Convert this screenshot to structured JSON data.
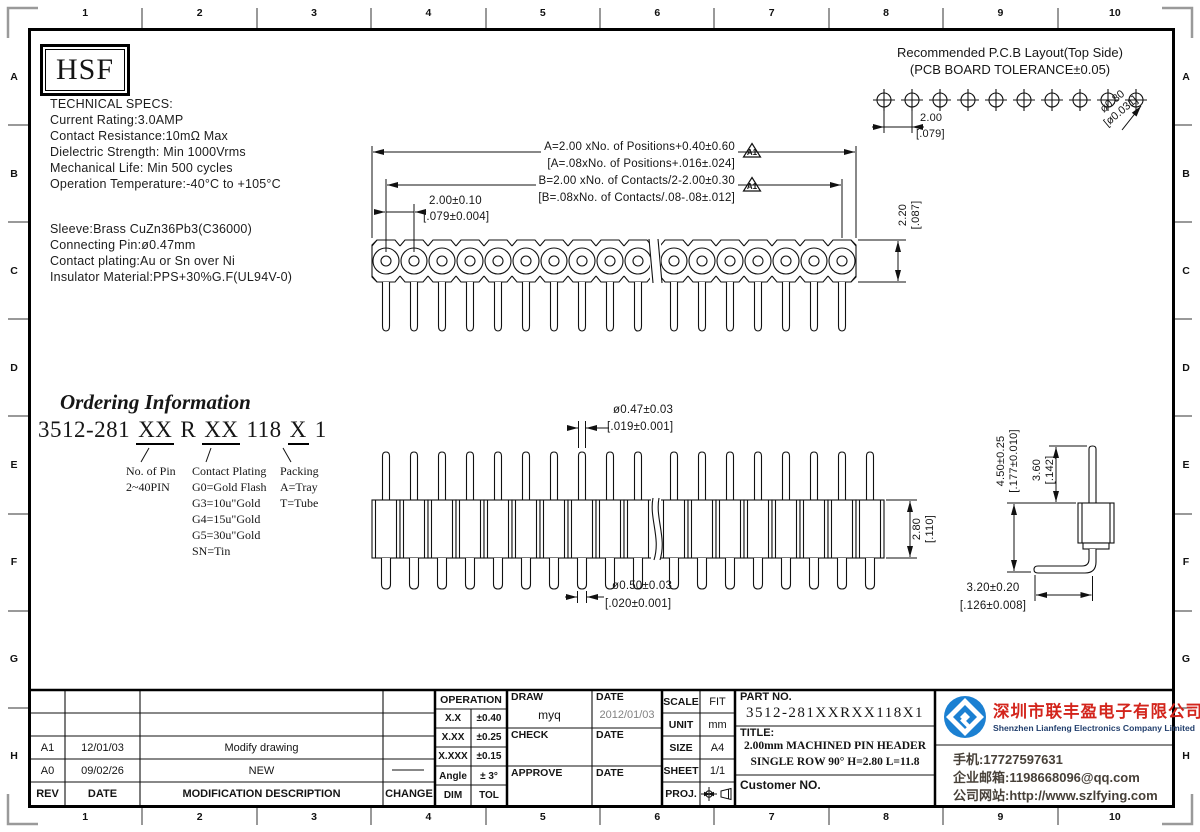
{
  "border": {
    "cols": [
      "1",
      "2",
      "3",
      "4",
      "5",
      "6",
      "7",
      "8",
      "9",
      "10"
    ],
    "rows": [
      "A",
      "B",
      "C",
      "D",
      "E",
      "F",
      "G",
      "H"
    ]
  },
  "logo": {
    "text": "HSF"
  },
  "specs": {
    "title": "TECHNICAL SPECS:",
    "lines": [
      "Current Rating:3.0AMP",
      "Contact Resistance:10mΩ Max",
      "Dielectric Strength: Min 1000Vrms",
      "Mechanical Life: Min 500 cycles",
      "Operation Temperature:-40°C to +105°C"
    ],
    "material_lines": [
      "Sleeve:Brass CuZn36Pb3(C36000)",
      "Connecting Pin:ø0.47mm",
      "Contact plating:Au or Sn over Ni",
      "Insulator Material:PPS+30%G.F(UL94V-0)"
    ]
  },
  "pcb_layout": {
    "title_line1": "Recommended P.C.B Layout(Top Side)",
    "title_line2": "(PCB BOARD TOLERANCE±0.05)",
    "pitch_dim": "2.00",
    "pitch_dim_in": "[.079]",
    "hole_dim": "ø0.80",
    "hole_dim_in": "[ø0.031]"
  },
  "top_view": {
    "dim_a_line1": "A=2.00 xNo. of Positions+0.40±0.60",
    "dim_a_line2": "[A=.08xNo. of Positions+.016±.024]",
    "dim_b_line1": "B=2.00 xNo. of Contacts/2-2.00±0.30",
    "dim_b_line2": "[B=.08xNo. of Contacts/.08-.08±.012]",
    "rev_flag": "A1",
    "pitch_dim": "2.00±0.10",
    "pitch_dim_in": "[.079±0.004]",
    "height_dim": "2.20",
    "height_dim_in": "[.087]"
  },
  "side_view": {
    "pin_dia": "ø0.47±0.03",
    "pin_dia_in": "[.019±0.001]",
    "tail_dia": "ø0.50±0.03",
    "tail_dia_in": "[.020±0.001]",
    "body_h": "2.80",
    "body_h_in": "[.110]"
  },
  "detail_view": {
    "total_h": "4.50±0.25",
    "total_h_in": "[.177±0.010]",
    "pin_h": "3.60",
    "pin_h_in": "[.142]",
    "leg_l": "3.20±0.20",
    "leg_l_in": "[.126±0.008]"
  },
  "ordering": {
    "title": "Ordering Information",
    "code": {
      "prefix": "3512-281",
      "pin": "XX",
      "mid": "R",
      "plating": "XX",
      "series": "118",
      "packing": "X",
      "suffix": "1"
    },
    "pin_label": "No. of Pin",
    "pin_range": "2~40PIN",
    "plating_label": "Contact Plating",
    "plating_options": [
      "G0=Gold Flash",
      "G3=10u\"Gold",
      "G4=15u\"Gold",
      "G5=30u\"Gold",
      "SN=Tin"
    ],
    "packing_label": "Packing",
    "packing_options": [
      "A=Tray",
      "T=Tube"
    ]
  },
  "revisions": {
    "headers": [
      "REV",
      "DATE",
      "MODIFICATION DESCRIPTION",
      "CHANGE"
    ],
    "rows": [
      {
        "rev": "",
        "date": "",
        "desc": "",
        "change": ""
      },
      {
        "rev": "",
        "date": "",
        "desc": "",
        "change": ""
      },
      {
        "rev": "A1",
        "date": "12/01/03",
        "desc": "Modify drawing",
        "change": ""
      },
      {
        "rev": "A0",
        "date": "09/02/26",
        "desc": "NEW",
        "change": ""
      }
    ]
  },
  "tolerances": {
    "title": "OPERATION",
    "rows": [
      {
        "dim": "X.X",
        "tol": "±0.40"
      },
      {
        "dim": "X.XX",
        "tol": "±0.25"
      },
      {
        "dim": "X.XXX",
        "tol": "±0.15"
      },
      {
        "dim": "Angle",
        "tol": "± 3°"
      },
      {
        "dim": "DIM",
        "tol": "TOL"
      }
    ]
  },
  "approvals": {
    "draw_label": "DRAW",
    "draw_value": "myq",
    "draw_date_label": "DATE",
    "draw_date_value": "2012/01/03",
    "check_label": "CHECK",
    "check_date_label": "DATE",
    "approve_label": "APPROVE",
    "approve_date_label": "DATE"
  },
  "info": {
    "scale_label": "SCALE",
    "scale_value": "FIT",
    "unit_label": "UNIT",
    "unit_value": "mm",
    "size_label": "SIZE",
    "size_value": "A4",
    "sheet_label": "SHEET",
    "sheet_value": "1/1",
    "proj_label": "PROJ."
  },
  "part": {
    "part_no_label": "PART NO.",
    "part_no": "3512-281XXRXX118X1",
    "title_label": "TITLE:",
    "title_line1": "2.00mm MACHINED PIN HEADER",
    "title_line2": "SINGLE ROW 90° H=2.80 L=11.8",
    "customer_label": "Customer NO."
  },
  "company": {
    "name_cn": "深圳市联丰盈电子有限公司",
    "name_en": "Shenzhen Lianfeng Electronics Company Limited",
    "phone": "手机:17727597631",
    "email": "企业邮箱:1198668096@qq.com",
    "website": "公司网站:http://www.szlfying.com",
    "brand_red": "#d3251c",
    "brand_blue": "#1b80d2"
  }
}
